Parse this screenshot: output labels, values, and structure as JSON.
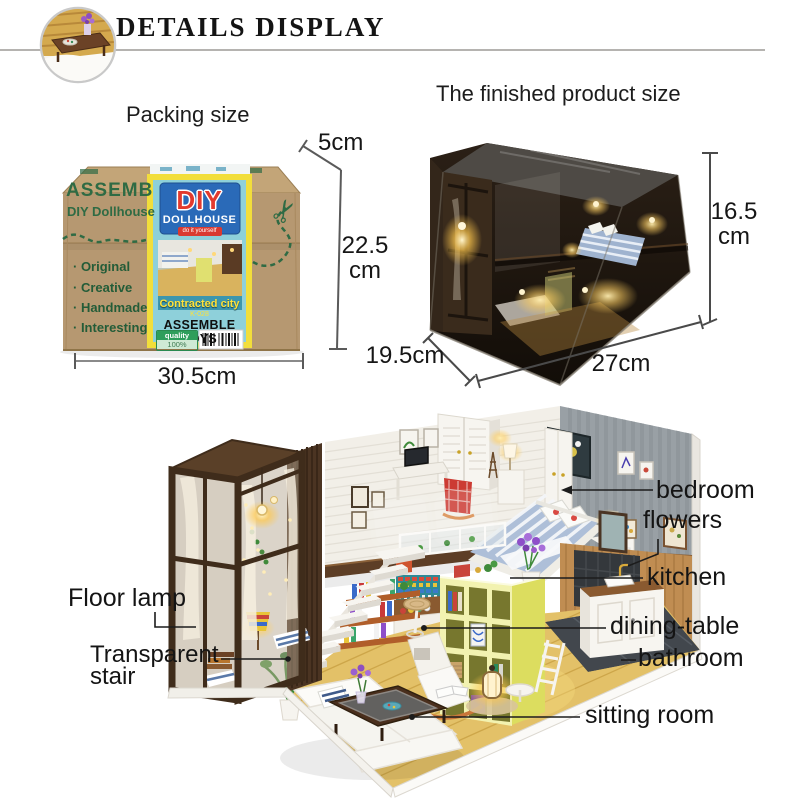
{
  "header": {
    "title": "DETAILS DISPLAY"
  },
  "packing": {
    "title": "Packing size",
    "dims": {
      "depth": "5cm",
      "height_value": "22.5",
      "height_unit": "cm",
      "width": "30.5cm"
    },
    "box": {
      "brand": "ASSEMB",
      "subtitle": "DIY Dollhouse",
      "features": [
        "· Original",
        "· Creative",
        "· Handmade",
        "· Interesting"
      ],
      "scissors_icon": "✂",
      "label": {
        "logo": "DIY",
        "logo_sub": "DOLLHOUSE",
        "tagline": "do it yourself",
        "product_name": "Contracted city",
        "sku": "K-028",
        "category": "ASSEMBLE TOYS",
        "quality_label": "quality",
        "quality_value": "100%"
      }
    }
  },
  "finished": {
    "title": "The finished product size",
    "dims": {
      "height_value": "16.5",
      "height_unit": "cm",
      "depth": "19.5cm",
      "width": "27cm"
    }
  },
  "callouts": {
    "floor_lamp": "Floor lamp",
    "transparent_stair": "Transparent stair",
    "bedroom": "bedroom",
    "flowers": "flowers",
    "kitchen": "kitchen",
    "dining_table": "dining-table",
    "bathroom": "bathroom",
    "sitting_room": "sitting room"
  },
  "colors": {
    "accent_green": "#2f6b44",
    "cardboard": "#b69871",
    "label_blue": "#8ed0da",
    "label_yellow": "#f2de3b",
    "logo_red": "#e23a2e",
    "logo_blue": "#2a6ab8",
    "warm_glow": "#ffd77a",
    "wood_floor": "#e3c168",
    "shelf_yellow": "#f2f2b0"
  }
}
